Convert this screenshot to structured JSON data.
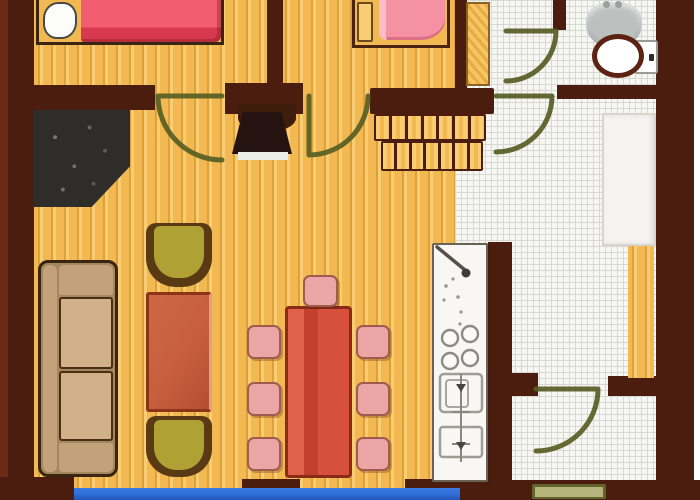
{
  "title": "apartment-floor-plan",
  "palette": {
    "wall": "#4b1d0e",
    "wall_light": "#6b2a12",
    "wood_base": "#f2b851",
    "wood_stripe": "#dfa039",
    "wood_light": "#f8cd74",
    "tile_bg": "#f6f6f3",
    "tile_line": "#d8d8d3",
    "door_olive": "#575d24",
    "bed_pink": "#f25e70",
    "bed_pink_dark": "#d8394f",
    "pillow_white": "#fcfcfa",
    "blanket_pink": "#f492a4",
    "blanket_light": "#f9bcc8",
    "sofa_tan": "#c2a17b",
    "sofa_dark": "#a5875e",
    "sofa_light": "#d0b189",
    "outline_dark": "#3a2412",
    "chair_olive": "#b0a135",
    "chair_shadow": "#5a3a14",
    "table_red": "#c75f3e",
    "table_red_dark": "#8c3418",
    "dining_red": "#d6503b",
    "dining_red_dark": "#8c2a18",
    "chair_pink": "#e9a6a4",
    "chair_pink_dark": "#a05a50",
    "closet_dark": "#2e2d2a",
    "tv_dark": "#241310",
    "counter_white": "#f8f7f4",
    "counter_line": "#a09c96",
    "metal_gray": "#bcc0be",
    "water_blue": "#2f6cd8",
    "mat_olive": "#b6b67c",
    "mat_olive_dark": "#63632c",
    "white_furniture": "#f4f3ef"
  },
  "rooms": [
    {
      "name": "bedroom-1",
      "floor": "wood",
      "furniture": [
        "double-bed",
        "pillow"
      ]
    },
    {
      "name": "bedroom-2",
      "floor": "wood",
      "furniture": [
        "single-bed",
        "bedside-cabinet"
      ]
    },
    {
      "name": "bathroom",
      "floor": "tile",
      "furniture": [
        "wash-basin",
        "toilet"
      ]
    },
    {
      "name": "hallway",
      "floor": "tile",
      "furniture": [
        "closet",
        "staircase"
      ]
    },
    {
      "name": "living-room",
      "floor": "wood",
      "furniture": [
        "sofa",
        "armchair",
        "armchair",
        "coffee-table",
        "tv",
        "dark-storage-nook"
      ]
    },
    {
      "name": "dining-area",
      "floor": "wood",
      "furniture": [
        "dining-table",
        "dining-chairs"
      ]
    },
    {
      "name": "kitchen",
      "floor": "tile",
      "furniture": [
        "counter-with-sink-and-stove",
        "white-wardrobe"
      ]
    },
    {
      "name": "entry-room",
      "floor": "tile",
      "furniture": [
        "doormat"
      ]
    }
  ],
  "counts": {
    "doors": 5,
    "stair_steps_upper": 7,
    "stair_steps_lower": 7,
    "dining_chairs": 7,
    "armchairs": 2,
    "beds": 2,
    "stove_burners": 4
  },
  "features": [
    "blue-terrace-edge-at-bottom",
    "tiled-corridor",
    "wood-plank-flooring"
  ]
}
